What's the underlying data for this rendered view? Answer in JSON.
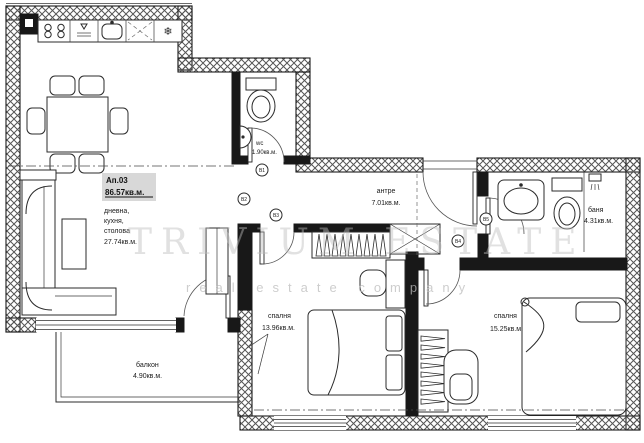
{
  "apartment": {
    "number": "Ап.03",
    "total_area": "86.57кв.м."
  },
  "rooms": {
    "living": {
      "line1": "дневна,",
      "line2": "кухня,",
      "line3": "столова",
      "area": "27.74кв.м."
    },
    "wc": {
      "name": "wc",
      "area": "1.90кв.м."
    },
    "antre": {
      "name": "антре",
      "area": "7.01кв.м."
    },
    "bath": {
      "name": "баня",
      "area": "4.31кв.м."
    },
    "bedroom1": {
      "name": "спалня",
      "area": "13.96кв.м."
    },
    "bedroom2": {
      "name": "спалня",
      "area": "15.25кв.м."
    },
    "balcony": {
      "name": "балкон",
      "area": "4.90кв.м."
    }
  },
  "markers": {
    "m1": "В1",
    "m2": "В2",
    "m3": "В3",
    "m4": "В4",
    "m5": "В5"
  },
  "icons": {
    "fridge_snowflake": "❄"
  },
  "watermark": {
    "line1": "TRIVIUM ESTATE",
    "line2": "real estate company"
  },
  "colors": {
    "wall": "#181818",
    "hatch_line": "#555555",
    "label_bg": "#d8d8d8",
    "watermark": "#bdbdbd"
  }
}
